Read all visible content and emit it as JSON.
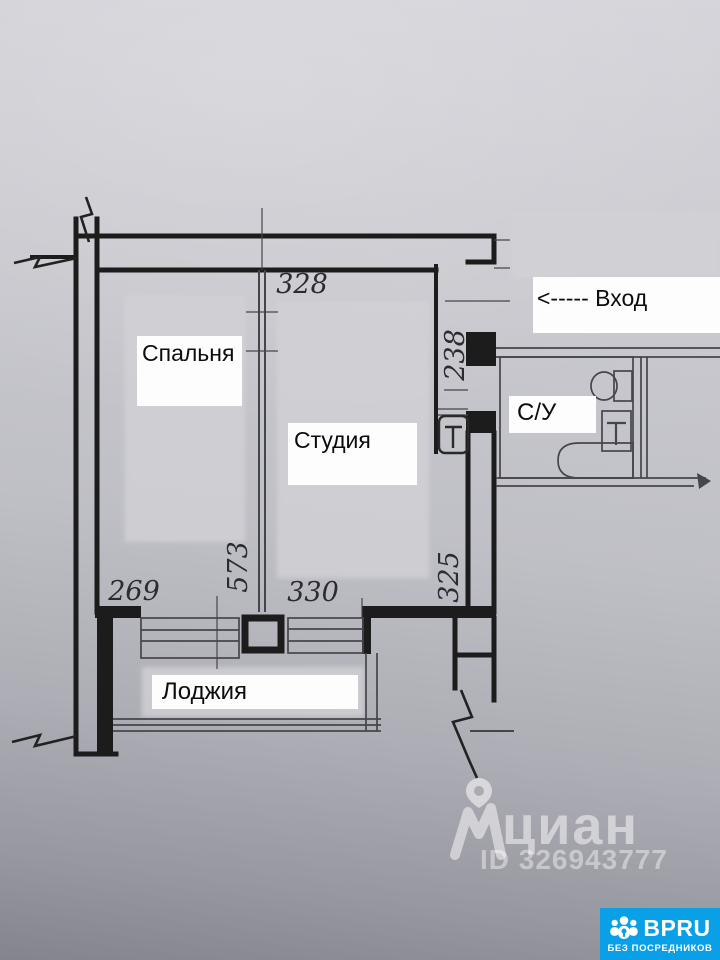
{
  "plan": {
    "rooms": {
      "bedroom": {
        "label": "Спальня"
      },
      "studio": {
        "label": "Студия"
      },
      "loggia": {
        "label": "Лоджия"
      },
      "bathroom": {
        "label": "С/У"
      }
    },
    "entrance_label": "<----- Вход",
    "dimensions": {
      "studio_top": "328",
      "entry_side": "238",
      "bedroom_bottom": "269",
      "room_depth": "573",
      "studio_bottom": "330",
      "right_side": "325"
    }
  },
  "watermark": {
    "brand": "циан",
    "listing_id": "ID 326943777",
    "pin_icon": "location-pin",
    "logo_icon": "cian-mark"
  },
  "badge": {
    "brand": "BPRU",
    "tagline": "БЕЗ ПОСРЕДНИКОВ",
    "icon": "people-group",
    "background_color": "#0aa0e8"
  },
  "colors": {
    "paper_top": "#d3d3d9",
    "paper_bottom": "#84848c",
    "wall_ink": "#1c1c1c",
    "thin_ink": "#45454b",
    "label_background": "#fdfdfd",
    "blur_patch": "#d2d2d6",
    "watermark_white": "rgba(255,255,255,0.5)"
  }
}
